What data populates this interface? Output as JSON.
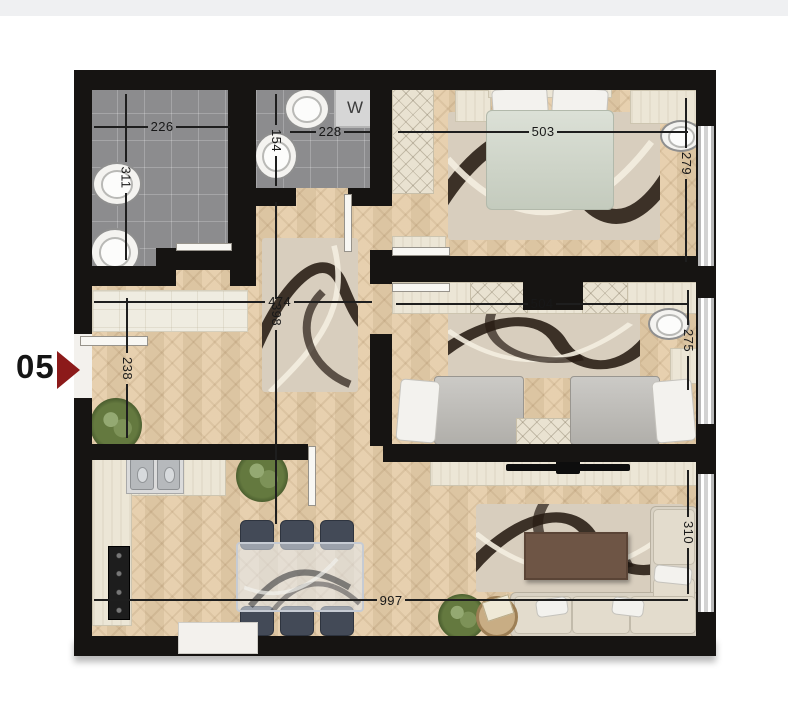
{
  "unit": {
    "number": "05"
  },
  "appliances": {
    "washer_label": "W"
  },
  "dimensions": {
    "bathroom_width": "226",
    "bathroom_depth": "311",
    "wc_depth": "154",
    "wc_width": "228",
    "hall_width": "474",
    "hall_depth": "398",
    "entry_width": "238",
    "bedroom1_width": "503",
    "bedroom1_depth": "279",
    "bedroom2_width": "504",
    "bedroom2_depth": "275",
    "open_area_width": "997",
    "living_depth": "310"
  },
  "colors": {
    "wall": "#161412",
    "parquet": "#e5cda9",
    "tile": "#8c8c8e",
    "arrow_accent": "#8c1a1a",
    "rug_dark": "#261b12",
    "duvet_sage": "#ccd3c5"
  }
}
